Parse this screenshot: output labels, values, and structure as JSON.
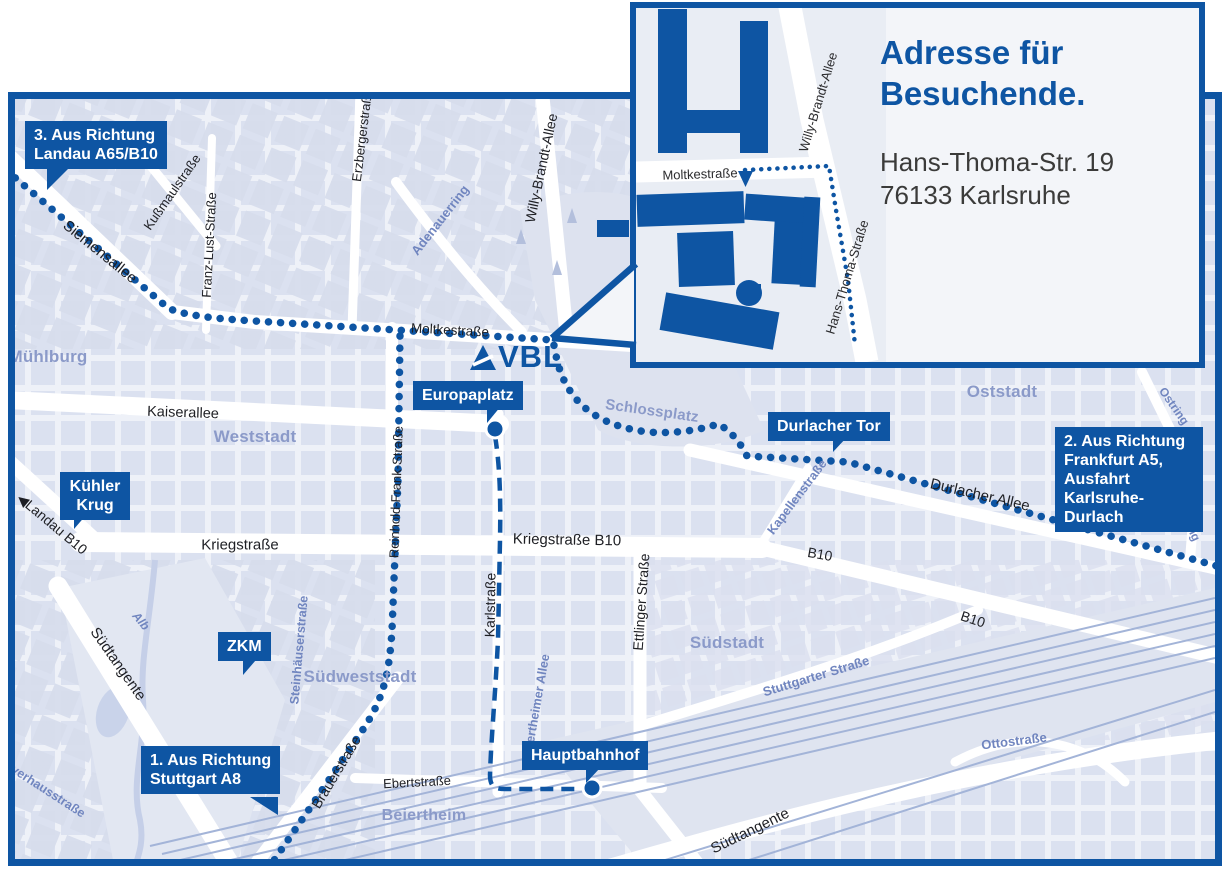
{
  "accent_color": "#0e55a3",
  "logo": {
    "text": "VBL"
  },
  "icons": {
    "left_arrow": "◀"
  },
  "inset": {
    "title_lines": [
      "Adresse für",
      "Besuchende."
    ],
    "address_lines": [
      "Hans-Thoma-Str. 19",
      "76133 Karlsruhe"
    ],
    "streets": {
      "moltkestrasse": "Moltkestraße",
      "willy_brandt_allee": "Willy-Brandt-Allee",
      "hans_thoma_strasse": "Hans-Thoma-Straße"
    }
  },
  "callouts": {
    "landau": {
      "lines": [
        "3. Aus Richtung",
        "Landau A65/B10"
      ]
    },
    "frankfurt": {
      "lines": [
        "2. Aus Richtung",
        "Frankfurt A5,",
        "Ausfahrt",
        "Karlsruhe-Durlach"
      ]
    },
    "stuttgart": {
      "lines": [
        "1. Aus Richtung",
        "Stuttgart A8"
      ]
    },
    "europaplatz": {
      "label": "Europaplatz"
    },
    "durlacher_tor": {
      "label": "Durlacher Tor"
    },
    "kuehler_krug": {
      "lines": [
        "Kühler",
        "Krug"
      ]
    },
    "zkm": {
      "label": "ZKM"
    },
    "hauptbahnhof": {
      "label": "Hauptbahnhof"
    }
  },
  "streets": {
    "siemensallee": "Siemensallee",
    "kussmaulstrasse": "Kußmaulstraße",
    "franz_lust_strasse": "Franz-Lust-Straße",
    "erzbergerstrasse": "Erzbergerstraße",
    "moltkestrasse": "Moltkestraße",
    "willy_brandt_allee": "Willy-Brandt-Allee",
    "adenauerring": "Adenauerring",
    "kaiserallee": "Kaiserallee",
    "reinhold_frank_strasse": "Reinhold-Frank-Straße",
    "kriegstrasse": "Kriegstraße",
    "kriegstrasse_b10": "Kriegstraße B10",
    "karlstrasse": "Karlstraße",
    "ettlinger_strasse": "Ettlinger Straße",
    "kapellenstrasse": "Kapellenstraße",
    "durlacher_allee": "Durlacher Allee",
    "b10_mid": "B10",
    "b10_right": "B10",
    "ostring_1": "Ostring",
    "ostring_2": "Ostring",
    "landau_b10": "Landau B10",
    "suedtangente_west": "Südtangente",
    "suedtangente_ost": "Südtangente",
    "brauerstrasse": "Brauerstraße",
    "ebertstrasse": "Ebertstraße",
    "steinhaeuserstrasse": "Steinhäuserstraße",
    "beiertheimer_allee": "Beiertheimer Allee",
    "stuttgarter_strasse": "Stuttgarter Straße",
    "ottostrasse": "Ottostraße",
    "pulverhausstrasse": "Pulverhausstraße",
    "alb": "Alb"
  },
  "districts": {
    "muehlburg": "Mühlburg",
    "weststadt": "Weststadt",
    "oststadt": "Oststadt",
    "suedstadt": "Südstadt",
    "suedweststadt": "Südweststadt",
    "beiertheim": "Beiertheim",
    "schlossplatz": "Schlossplatz"
  }
}
